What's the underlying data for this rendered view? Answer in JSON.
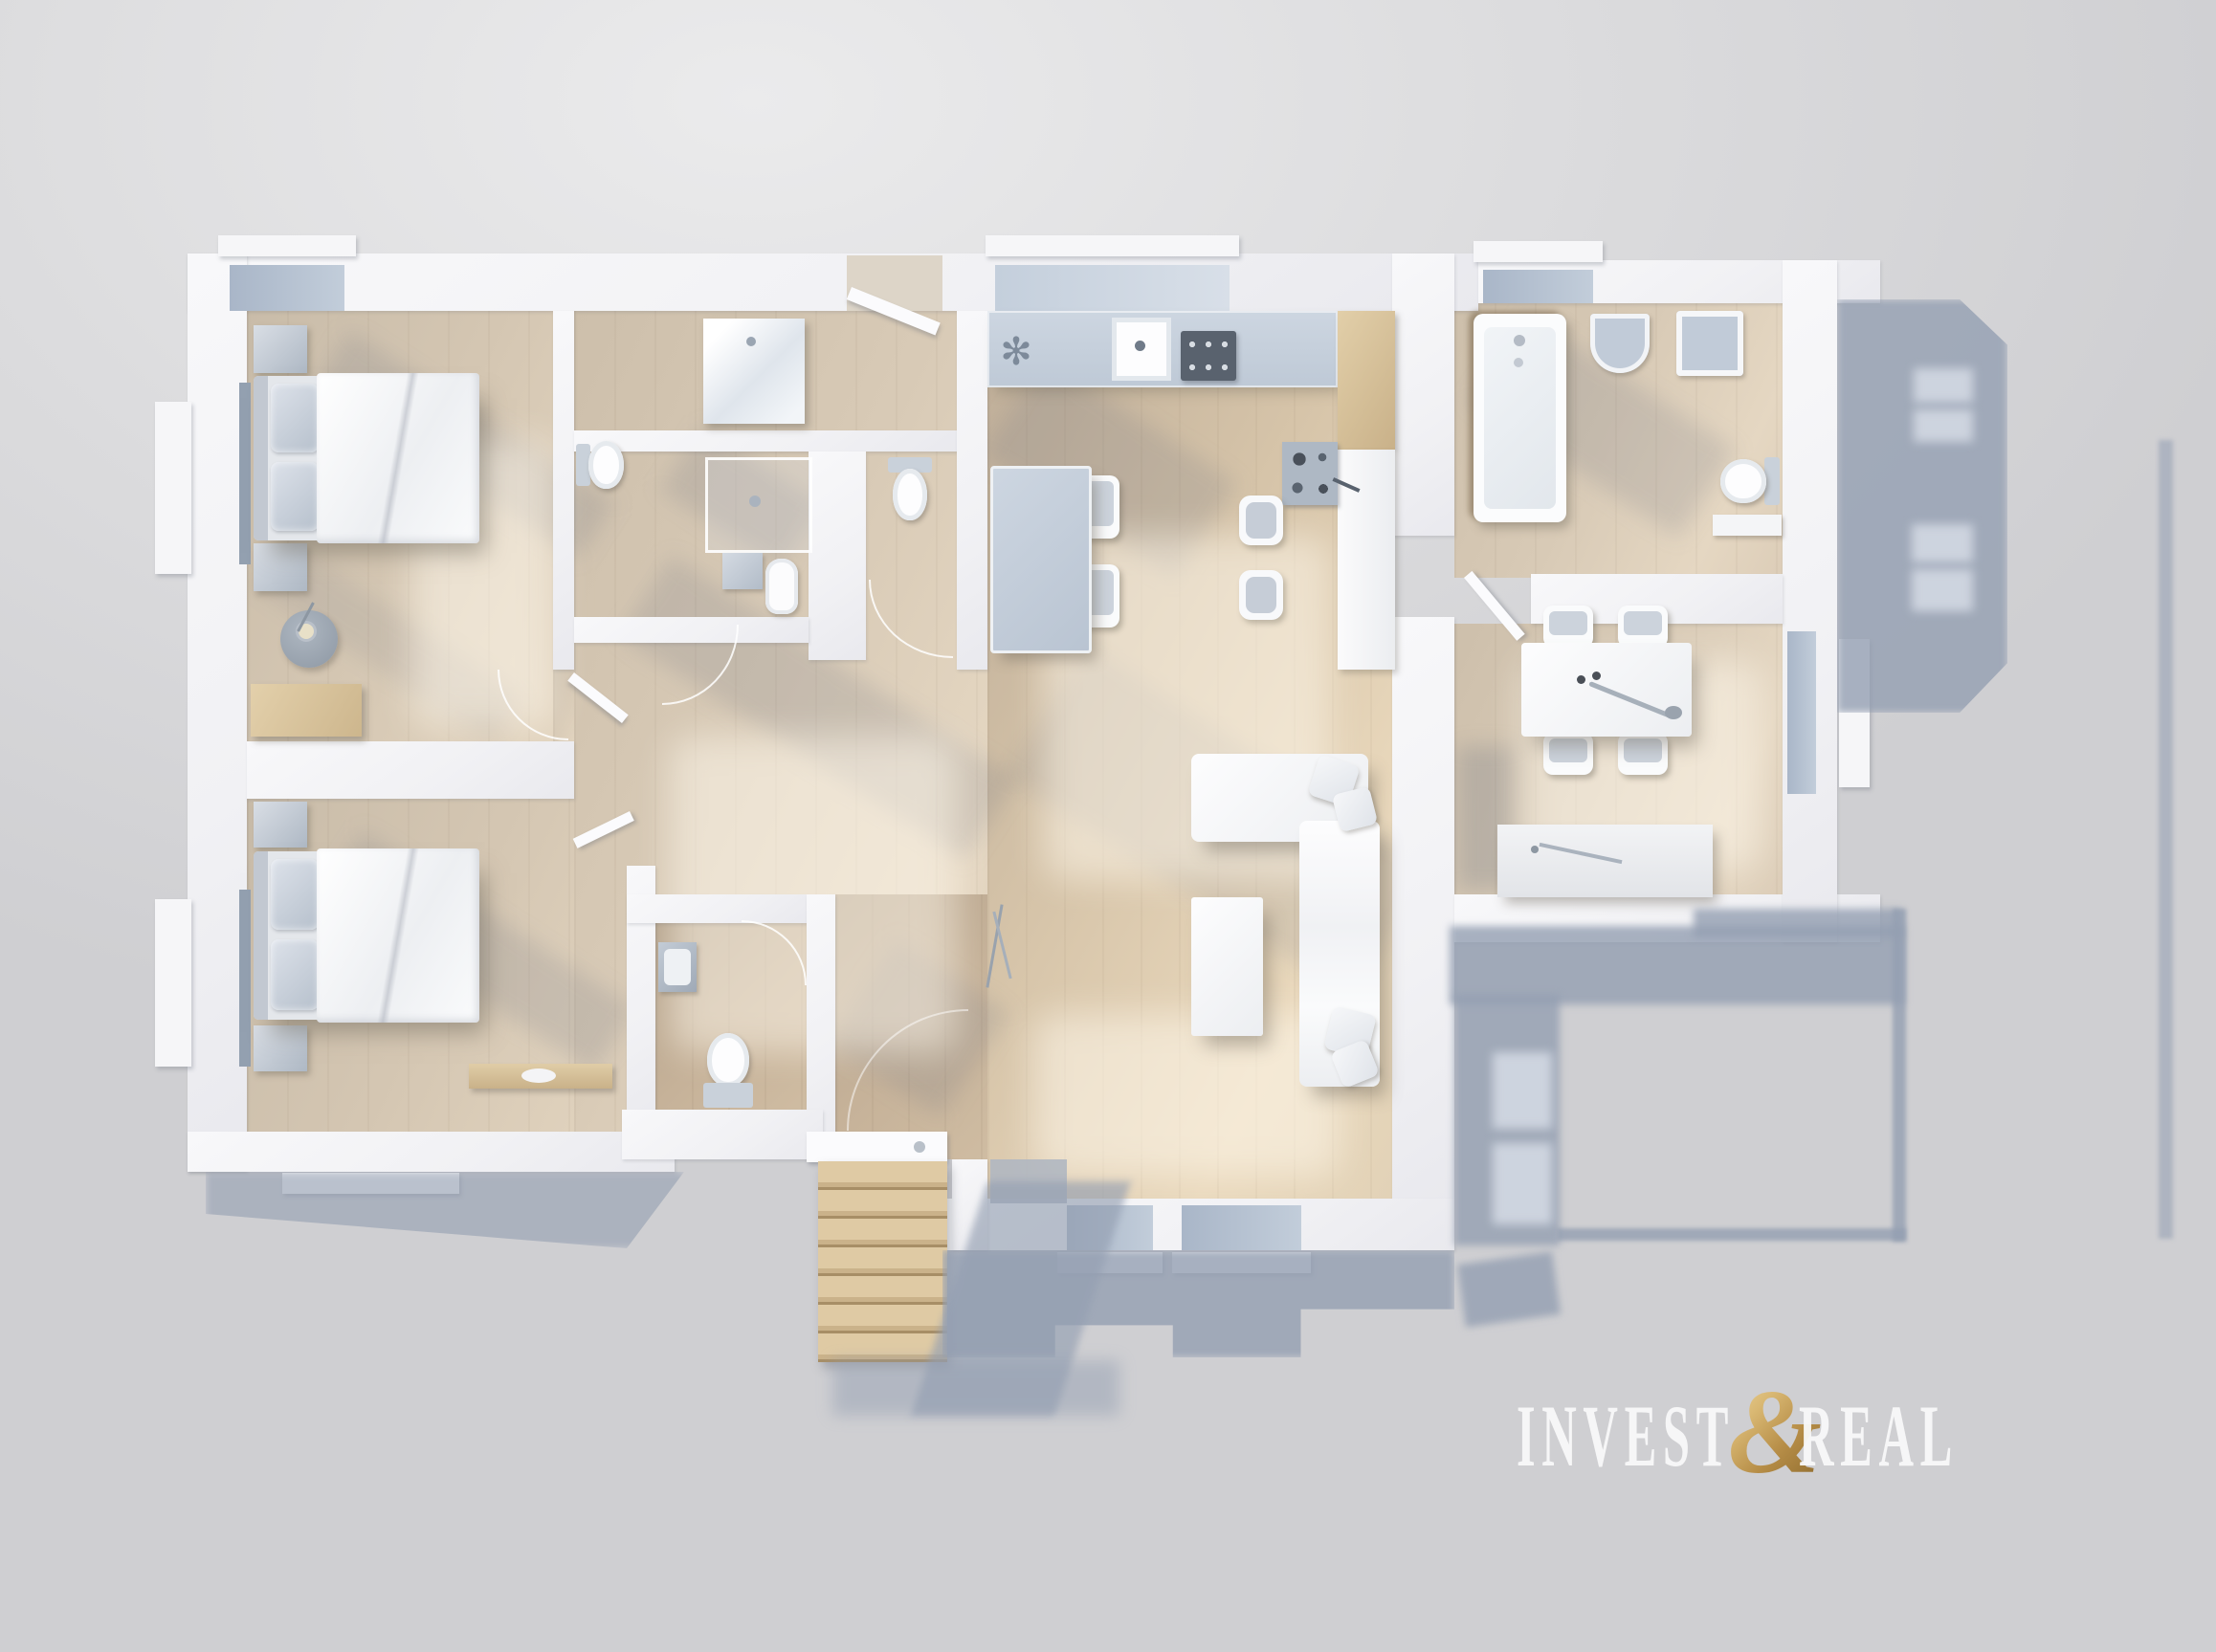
{
  "watermark": {
    "invest": "INVEST",
    "ampersand": "&",
    "real": "REAL"
  },
  "scene": {
    "type": "3d-floor-plan-top-down-render",
    "rooms": [
      "bedroom-top-left",
      "bedroom-bottom-left",
      "bathroom-vanity",
      "shower-room",
      "wc-cubicle",
      "wc-with-sink",
      "hallway",
      "entry-hall",
      "kitchen",
      "living-room",
      "dining-room",
      "bathroom-with-tub",
      "exterior-stairs"
    ]
  },
  "colors": {
    "bg-light": "#ebebec",
    "bg-mid": "#dbdbdd",
    "bg-dark": "#cfcfd2",
    "wall": "#f4f4f6",
    "floor-warm": "#d7c9b5",
    "floor-light": "#e7dac5",
    "floor-dark": "#c2b29e",
    "glass": "#b7c3d3",
    "counter-blue": "#c7d1dc",
    "furniture-gray": "#b9c2cd",
    "wood": "#d9c29c",
    "ext-shadow": "#9aa6ba",
    "gold-light": "#d9b873",
    "gold-dark": "#8e6b2e",
    "text-white": "#f9f9f9"
  }
}
